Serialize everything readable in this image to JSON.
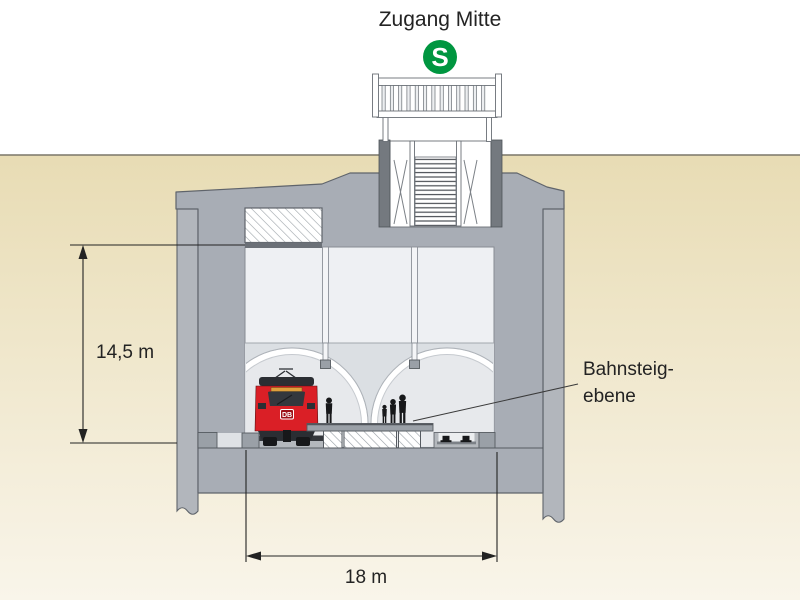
{
  "diagram": {
    "title": "Zugang Mitte",
    "logo_letter": "S",
    "train_logo": "DB",
    "dimensions": {
      "depth": "14,5 m",
      "width": "18 m"
    },
    "labels": {
      "platform_line1": "Bahnsteig-",
      "platform_line2": "ebene"
    },
    "colors": {
      "ground_top": "#e8dcb4",
      "ground_bottom": "#f9f5ea",
      "concrete": "#a8adb5",
      "concrete_outline": "#5f646b",
      "pile": "#b2b6bc",
      "shaft_wall": "#74797f",
      "interior_upper": "#eef0f3",
      "interior_tunnel": "#dbdfe3",
      "tube_fill": "#e7e9ec",
      "train_red": "#da1f26",
      "sbahn_green": "#009640",
      "text": "#232323"
    }
  }
}
